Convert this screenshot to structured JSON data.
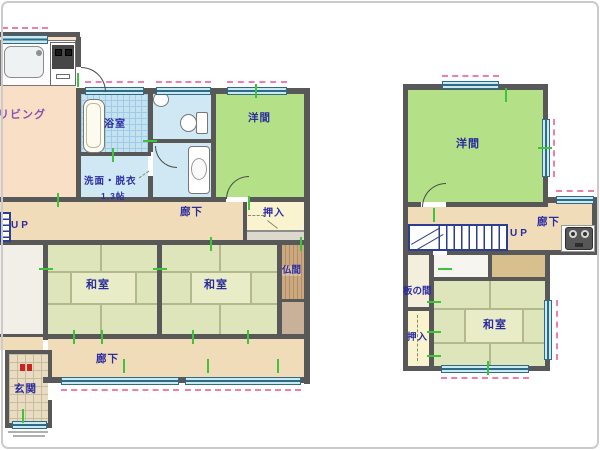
{
  "plan_title": "two-storey house floor plan",
  "colors": {
    "wall": "#585858",
    "living": "#f8dfc5",
    "corridor": "#f0dcb8",
    "tatami": "#dfe5ba",
    "western_room": "#b4e188",
    "wet_area_blue": "#cfe8f4",
    "closet_cream": "#faf3cf",
    "window_teal": "#c9eaf0",
    "shutter_pink": "#ee7fa9",
    "center_mark_green": "#3fc33a",
    "label_navy": "#2b2ba0",
    "label_purple": "#8a52b2",
    "stairs_blue": "#2c3e8f"
  },
  "floor1": {
    "rooms": {
      "living": "リビング",
      "bath": "浴室",
      "washroom": "洗面・脱衣",
      "washroom_size": "1.3帖",
      "hall_upper": "廊下",
      "stairs_up": "UP",
      "closet": "押入",
      "western_room": "洋間",
      "washitsu_left": "和室",
      "washitsu_right": "和室",
      "butsuma": "仏間",
      "hall_lower": "廊下",
      "entrance": "玄関"
    }
  },
  "floor2": {
    "rooms": {
      "western_room": "洋間",
      "hall": "廊下",
      "stairs_up": "UP",
      "itanoma": "板の間",
      "closet": "押入",
      "washitsu": "和室"
    }
  }
}
